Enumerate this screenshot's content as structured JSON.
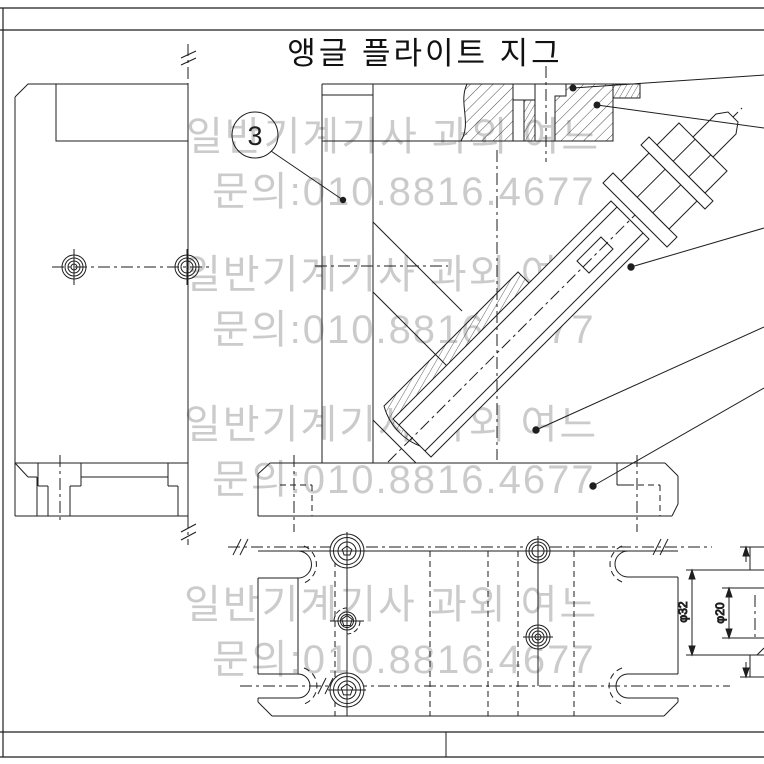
{
  "drawing": {
    "title": "앵글 플라이트 지그",
    "balloon_number": "3",
    "watermark_line1": "일반기계기사 과외 여느",
    "watermark_line2": "문의:010.8816.4677",
    "dim_phi32": "φ32",
    "dim_phi20": "φ20",
    "colors": {
      "line": "#1e1e1e",
      "watermark": "#cbcbcb",
      "background": "#ffffff"
    },
    "views": {
      "left_view": "side view of angle plate",
      "front_view": "sectioned front view with 45° clamp assembly",
      "plan_view": "base plate top view with clamping slots",
      "partial_view": "partial section of round workpiece"
    }
  }
}
